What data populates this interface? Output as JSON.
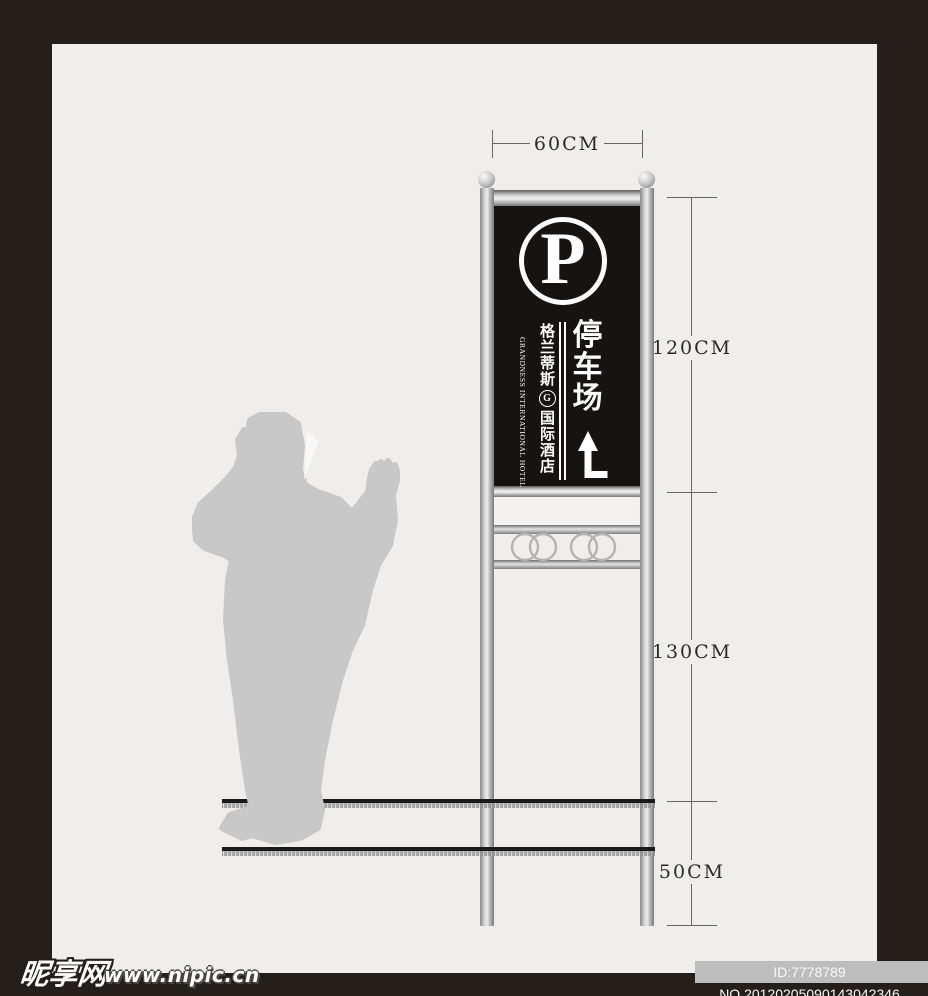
{
  "page": {
    "background_color": "#efeeec",
    "frame_color": "#241f1b"
  },
  "dimension_annotations": {
    "width": {
      "label": "60CM"
    },
    "heights": [
      {
        "label": "120CM"
      },
      {
        "label": "130CM"
      },
      {
        "label": "50CM"
      }
    ]
  },
  "sign": {
    "parking_symbol": "P",
    "main_text": "停车场",
    "main_chars": [
      "停",
      "车",
      "场"
    ],
    "hotel_name_upper": "格兰蒂斯",
    "hotel_name_lower": "国际酒店",
    "hotel_logo_letter": "G",
    "hotel_name_en": "GRANDNESS INTERNATIONAL HOTEL",
    "arrow_meaning": "ahead-then-left-turn",
    "panel_color": "#171310",
    "text_color": "#ffffff"
  },
  "watermark": {
    "site_name": "昵享网",
    "site_url": "www.nipic.cn",
    "image_id": "ID:7778789 NO.20120205090143042346"
  },
  "colors": {
    "silhouette": "#c8c8c8",
    "pole_silver": "#cfcfcf",
    "ornament_rings": "#b3b3b3",
    "dimension_lines": "#666666",
    "ground_line": "#1a1a1a"
  }
}
